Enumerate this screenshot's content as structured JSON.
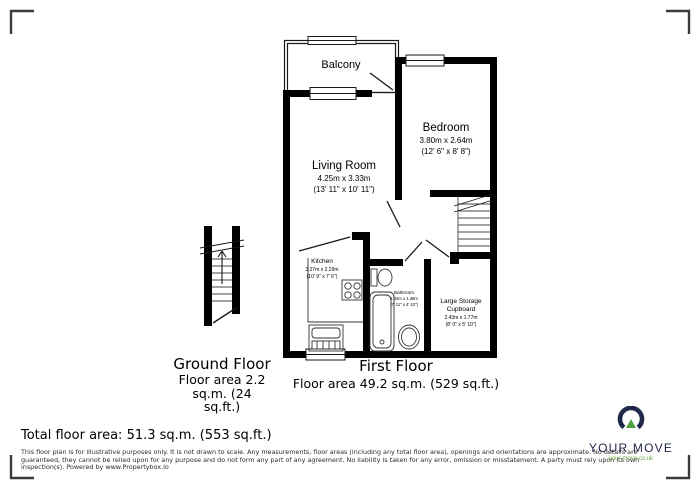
{
  "floorplan": {
    "balcony": {
      "label": "Balcony"
    },
    "living_room": {
      "label": "Living Room",
      "dims_m": "4.25m x 3.33m",
      "dims_ft": "(13' 11\" x 10' 11\")"
    },
    "bedroom": {
      "label": "Bedroom",
      "dims_m": "3.80m x 2.64m",
      "dims_ft": "(12' 6\" x 8' 8\")"
    },
    "kitchen": {
      "label": "Kitchen",
      "dims_m": "3.27m x 2.29m",
      "dims_ft": "(10' 9\" x 7' 6\")"
    },
    "bathroom": {
      "label": "Bathroom",
      "dims_m": "2.42m x 1.48m",
      "dims_ft": "(7' 11\" x 4' 10\")"
    },
    "storage": {
      "label_line1": "Large Storage",
      "label_line2": "Cupboard",
      "dims_m": "2.43m x 1.77m",
      "dims_ft": "(8' 0\" x 5' 10\")"
    }
  },
  "floors": {
    "ground": {
      "title": "Ground Floor",
      "area_line1": "Floor area 2.2",
      "area_line2": "sq.m. (24",
      "area_line3": "sq.ft.)"
    },
    "first": {
      "title": "First Floor",
      "area": "Floor area 49.2 sq.m. (529 sq.ft.)"
    }
  },
  "total_area": "Total floor area: 51.3 sq.m. (553 sq.ft.)",
  "disclaimer": {
    "line1": "This floor plan is for illustrative purposes only. It is not drawn to scale. Any measurements, floor areas (including any total floor area), openings and orientations are approximate. No details are",
    "line2": "guaranteed, they cannot be relied upon for any purpose and do not form any part of any agreement. No liability is taken for any error, omission or misstatement. A party must rely upon its own",
    "line3": "inspection(s). Powered by www.Propertybox.io"
  },
  "logo": {
    "brand": "YOUR MOVE",
    "url": "your-move.co.uk",
    "navy": "#20294a",
    "green": "#55a03e"
  }
}
